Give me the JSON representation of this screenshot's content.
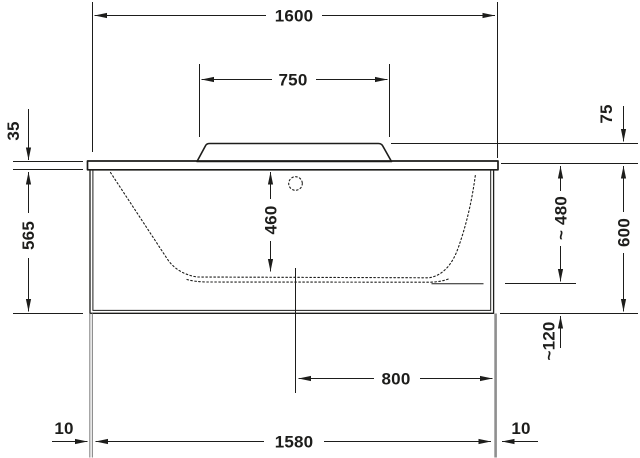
{
  "drawing": {
    "product": "bathtub-side-elevation-technical-drawing",
    "colors": {
      "line": "#1d1d1b",
      "leg": "#8f8f8f",
      "background": "#ffffff"
    },
    "dims": {
      "overall_length": "1600",
      "backrest_width": "750",
      "rim_thickness": "35",
      "body_height": "565",
      "inner_depth": "460",
      "headrest_height": "75",
      "approx_water_depth": "~ 480",
      "total_height": "600",
      "floor_clearance": "~120",
      "drain_distance": "800",
      "foot_inset_left": "10",
      "foot_spacing": "1580",
      "foot_inset_right": "10"
    }
  }
}
